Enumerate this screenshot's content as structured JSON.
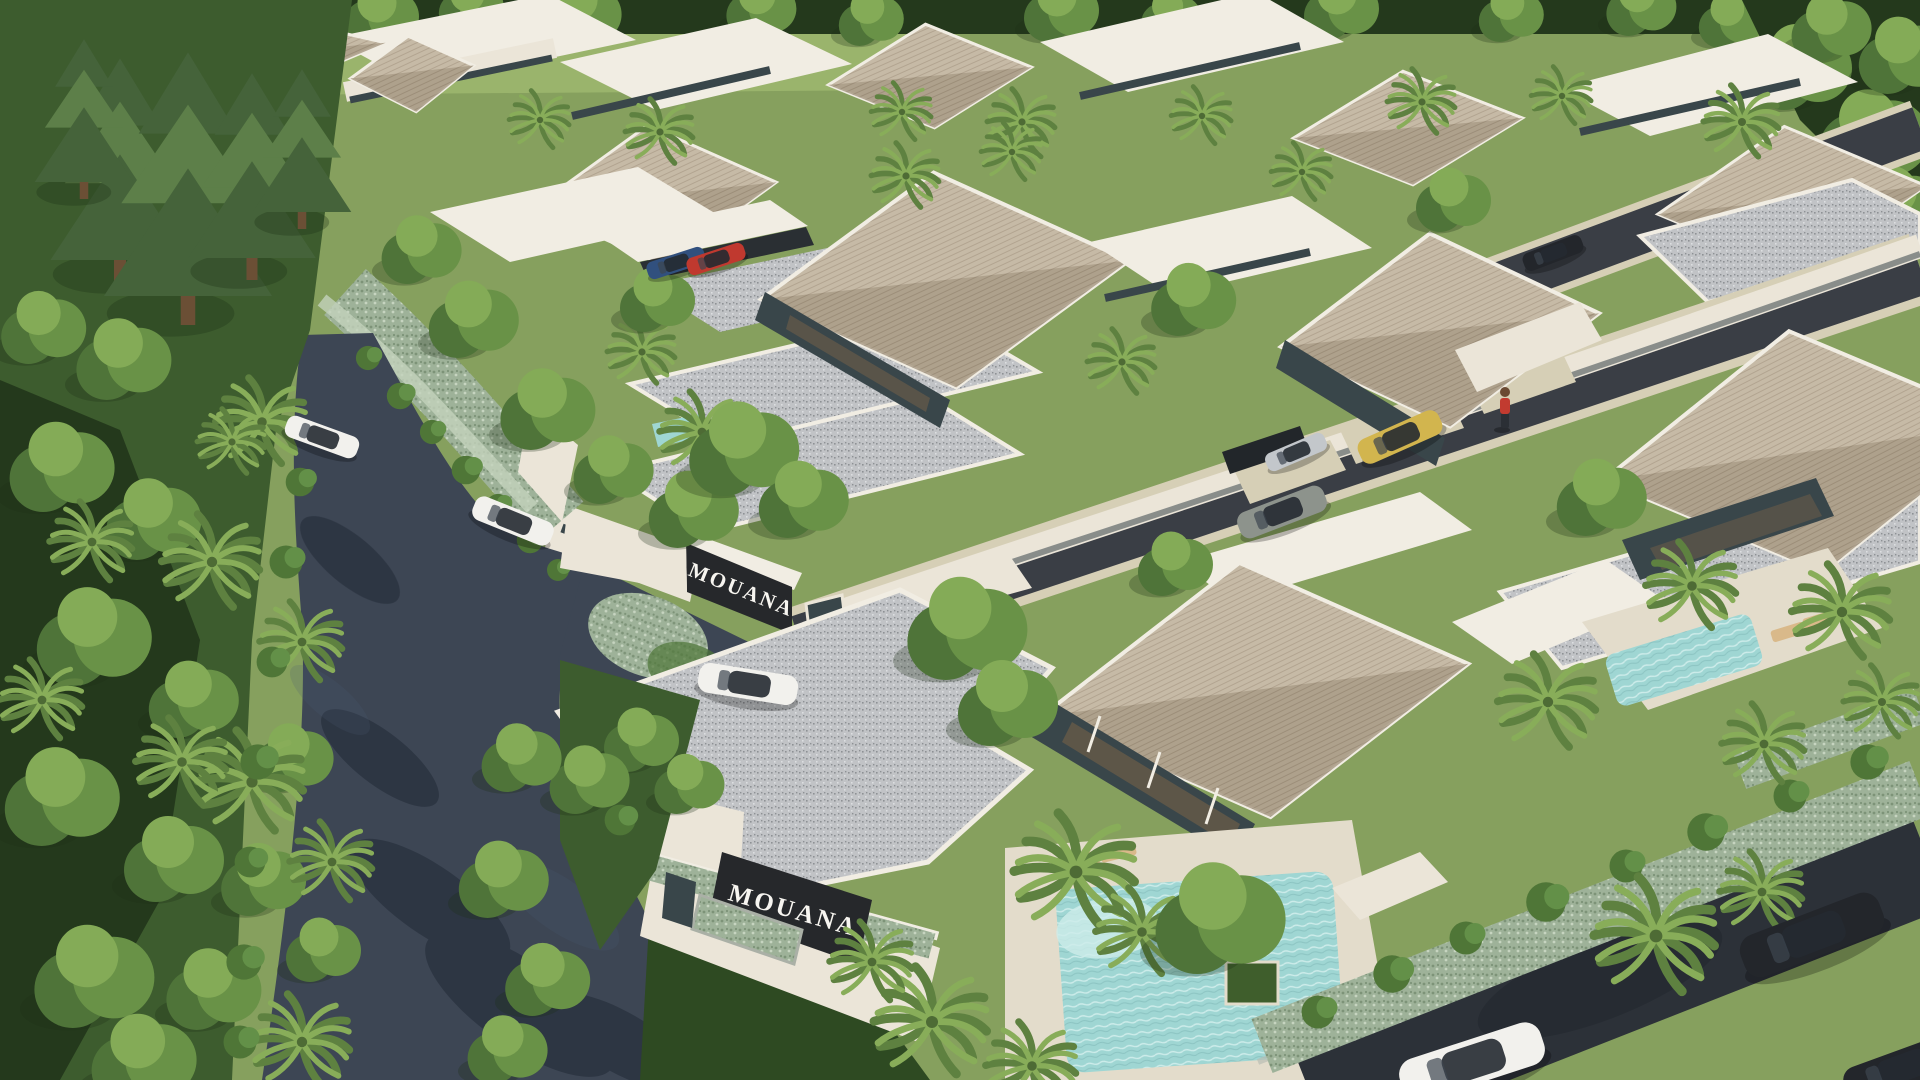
{
  "scene": {
    "type": "3D aerial architectural rendering",
    "subject": "MOUANA gated tropical pool-villa community seen from above, bordered by forest and curving access roads",
    "brand": "MOUANA"
  },
  "signs": {
    "entrance": "MOUANA",
    "corner": "MOUANA"
  },
  "colors": {
    "grass": "#86a05e",
    "grassLight": "#9ab46c",
    "lawnDark": "#2e4a22",
    "forest": "#3d5c2e",
    "forestDark": "#24391c",
    "treeLo": "#4f7439",
    "treeMid": "#699247",
    "treeHi": "#84ab57",
    "pine": "#45633a",
    "pineHi": "#5d7f49",
    "palmDark": "#5e8140",
    "palmLight": "#88ad59",
    "bush": "#4f7637",
    "bushHi": "#639048",
    "hedge": "#9eb299",
    "hedgeDot": "#7d9378",
    "hedgeDot2": "#c6d4c0",
    "hedgeLight": "#c3d2bb",
    "roadMain": "#3d4654",
    "roadInner": "#3a3e45",
    "roadOuter": "#2c3138",
    "roadShade": "#1f2733",
    "roadBlue": "#4a5a74",
    "curb": "#d6cfb6",
    "curbStone": "#b9bdb3",
    "wall": "#ebe5d8",
    "wallShade": "#d2cabb",
    "whiteRoof": "#f1ede3",
    "shingleLit": "#c6baa6",
    "shingleLitLine": "#b2a490",
    "shingleShade": "#aa9c87",
    "shingleShadeLine": "#988a75",
    "gravel": "#c1c3c6",
    "gravelDark": "#8e9195",
    "gravelLight": "#dcdee0",
    "glass": "#39464a",
    "interior": "#8a6a48",
    "pool": "#9fd6d3",
    "poolLight": "#cdecea",
    "deck": "#e3dccb",
    "signPanel": "#26282b",
    "signText": "#f7f5f0",
    "wood": "#caa06a",
    "lounger": "#d9b98a",
    "carWhite": "#f2f1ed",
    "carSilver": "#c3c7cb",
    "carGray": "#8d938c",
    "carGold": "#d2b54e",
    "carRed": "#c0392f",
    "carBlue": "#31507e",
    "carBlack": "#23262b",
    "personShirt": "#c23b30"
  },
  "objects": {
    "cars": [
      {
        "color": "white",
        "where": "curving entrance road"
      },
      {
        "color": "white",
        "where": "passing the entrance gate"
      },
      {
        "color": "white",
        "where": "upper part of entrance road"
      },
      {
        "color": "gray",
        "where": "interior street"
      },
      {
        "color": "silver",
        "where": "villa driveway"
      },
      {
        "color": "gold",
        "where": "villa driveway"
      },
      {
        "color": "blue",
        "where": "carport"
      },
      {
        "color": "red",
        "where": "carport"
      },
      {
        "color": "dark",
        "where": "upper interior street"
      },
      {
        "color": "black",
        "where": "lower-right perimeter road"
      },
      {
        "color": "white",
        "where": "lower-right perimeter road"
      },
      {
        "color": "black",
        "where": "bottom-right corner"
      }
    ],
    "pools": [
      "foreground villa pool",
      "right villa pool",
      "small courtyard pool"
    ],
    "people": [
      {
        "shirt": "red",
        "where": "walkway beside upper villas"
      }
    ]
  }
}
